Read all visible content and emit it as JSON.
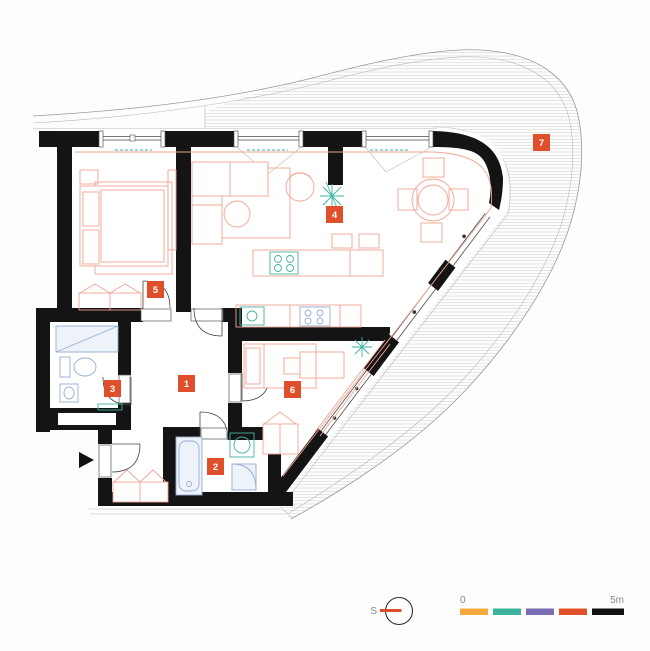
{
  "plan": {
    "rooms": [
      {
        "number": "1"
      },
      {
        "number": "2"
      },
      {
        "number": "3"
      },
      {
        "number": "4"
      },
      {
        "number": "5"
      },
      {
        "number": "6"
      },
      {
        "number": "7"
      }
    ],
    "label_color": "#e04f2b"
  },
  "legend": {
    "scale_start_label": "0",
    "scale_end_label": "5m",
    "bar_colors": [
      "#f3a93c",
      "#3cb49b",
      "#7a6cb0",
      "#e0512b",
      "#121212"
    ],
    "compass_label": "S",
    "compass_color": "#d94f2b"
  }
}
